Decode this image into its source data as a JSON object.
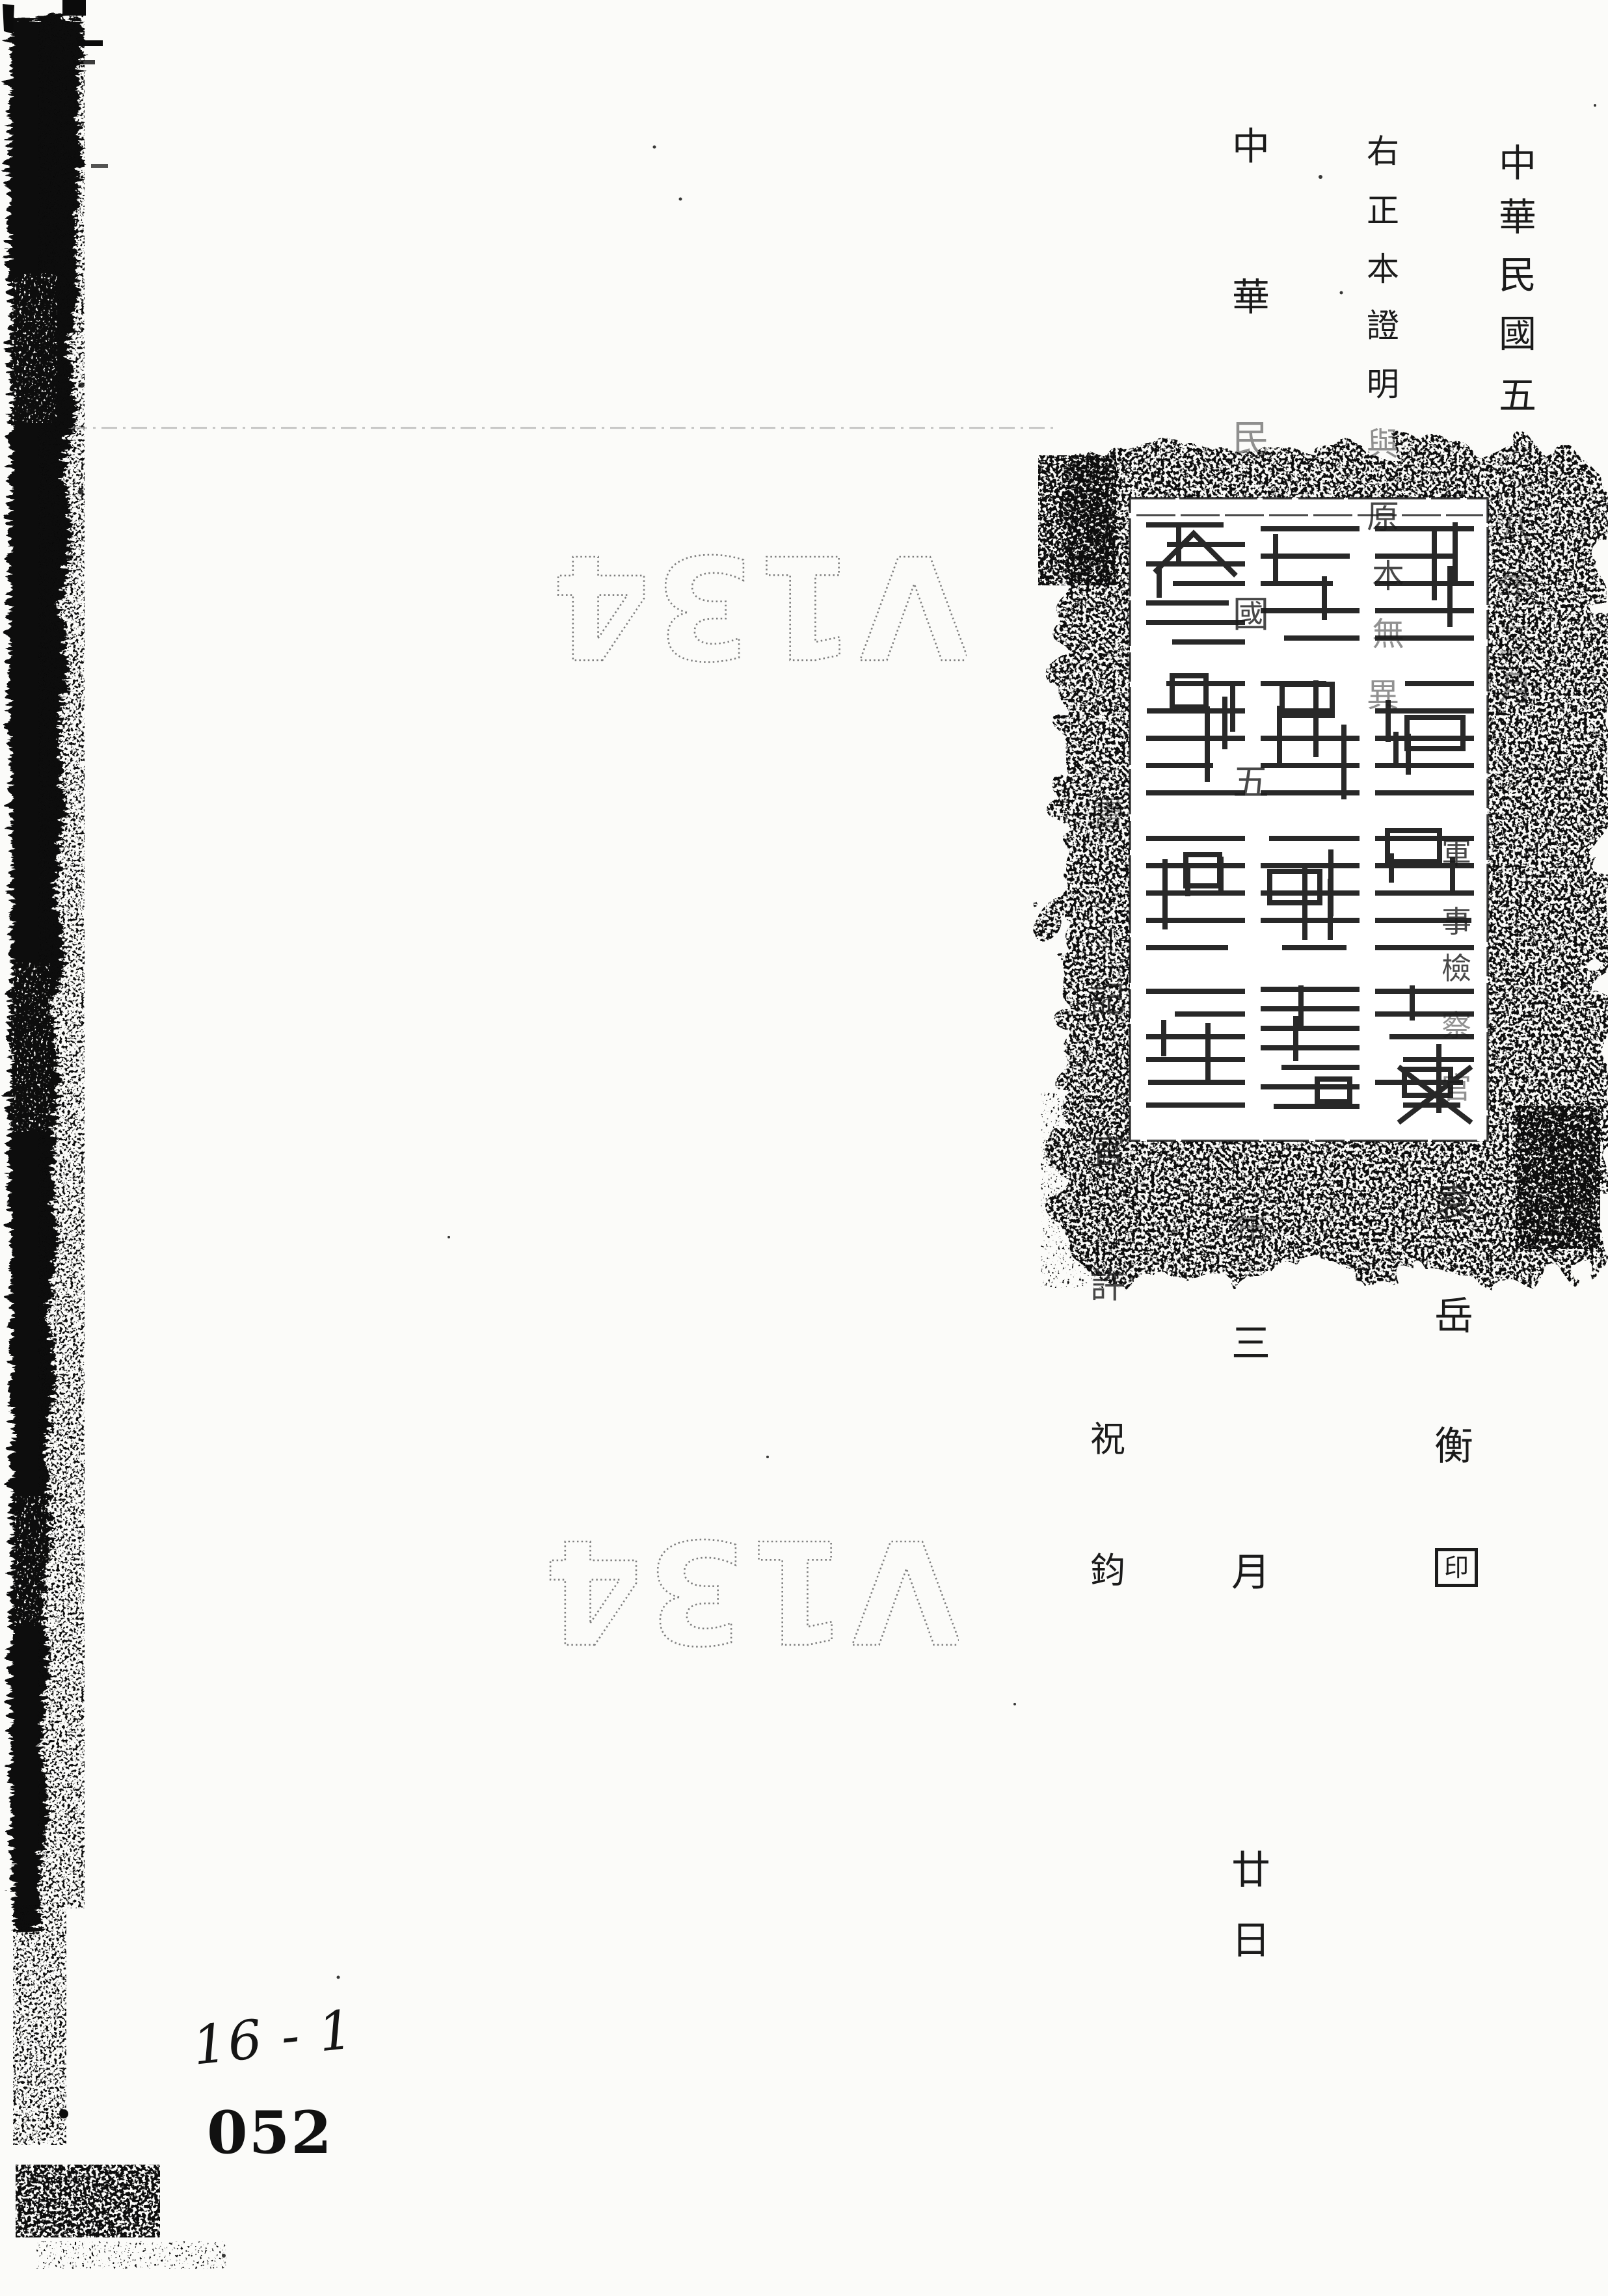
{
  "page": {
    "kind": "scanned archival document page",
    "background": "#fbfbf9",
    "ink": "#1b1b1b"
  },
  "columns": {
    "a": {
      "label": "date line top right",
      "chars": [
        "中",
        "華",
        "民",
        "國",
        "五",
        "八",
        "年",
        "三",
        "月"
      ]
    },
    "b": {
      "label": "certification statement",
      "chars": [
        "右",
        "正",
        "本",
        "證",
        "明",
        "與",
        "原",
        "本",
        "無",
        "異"
      ]
    },
    "p": {
      "label": "prosecutor title",
      "chars": [
        "軍",
        "事",
        "檢",
        "察",
        "官"
      ]
    },
    "n": {
      "label": "prosecutor name",
      "chars": [
        "袁",
        "岳",
        "衡"
      ],
      "seal_char": "印"
    },
    "d": {
      "label": "certified copy date",
      "chars": [
        "中",
        "華",
        "民",
        "國",
        "五",
        "年",
        "三",
        "月",
        "廿",
        "日"
      ]
    },
    "k": {
      "label": "clerk line",
      "chars": [
        "書",
        "記",
        "官",
        "許",
        "祝",
        "鈞"
      ]
    }
  },
  "stamp": {
    "type": "official rectangular seal",
    "script": "seal script",
    "ink": "#151515"
  },
  "watermark": {
    "text": "V134",
    "color": "#7f7f7f",
    "rotation_deg": 180
  },
  "annotations": {
    "handwritten_number": "16 - 1",
    "page_number": "052"
  }
}
